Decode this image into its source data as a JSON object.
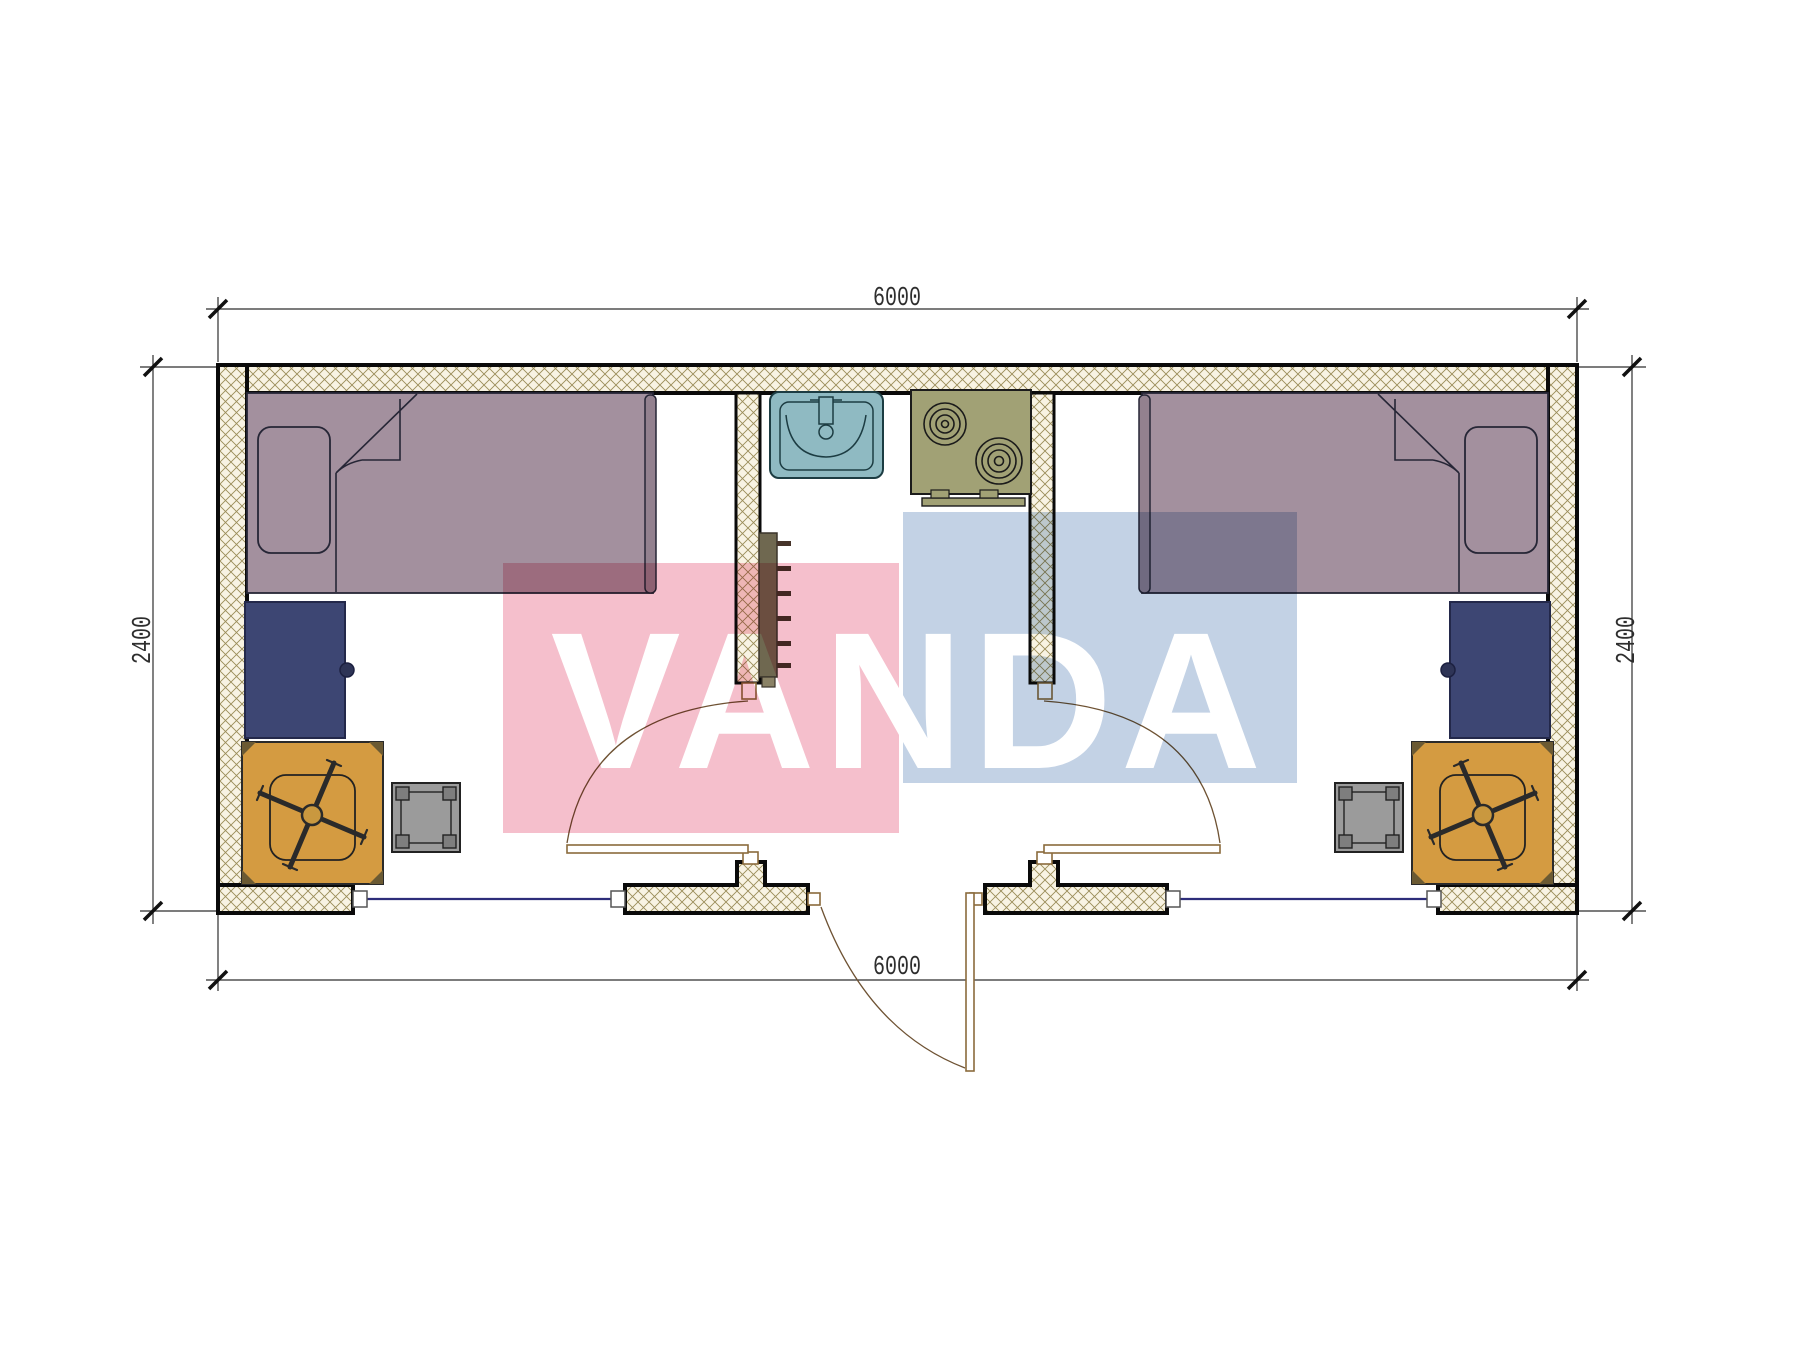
{
  "title": "Container house floor plan 6000 x 2400 - two rooms with central kitchen and sink",
  "watermark": {
    "text": "VANDA",
    "pink_block_color": "#f5bfcc",
    "blue_block_color": "#c3d2e5",
    "letter_color": "#ffffff"
  },
  "dimensions": {
    "top": "6000",
    "bottom": "6000",
    "left": "2400",
    "right": "2400"
  },
  "colors": {
    "wall_hatch_bg": "#f8f3e3",
    "wall_hatch_line": "#9a8c58",
    "wall_outline": "#0a0a0a",
    "bed": "#a3909e",
    "bed_footboard": "#93818f",
    "pillow": "#a3909e",
    "desk": "#3d4673",
    "desk_knob": "#2e3456",
    "chair_mat": "#d49b41",
    "stool": "#9b9b9b",
    "stool_post": "#7e7e7e",
    "sink": "#8fbac2",
    "stove": "#a1a175",
    "radiator": "#6f6850",
    "radiator_rung": "#46342a",
    "door_line": "#8a6b3c",
    "window_line": "#2d2d7a",
    "dimension_line": "#2e2e2e"
  },
  "elements": {
    "left_room": [
      "bed with pillow and folded blanket",
      "desk with knob",
      "office chair on square mat",
      "square stool"
    ],
    "center_core": [
      "wash basin with faucet",
      "two-burner stove",
      "wall radiator ladder"
    ],
    "right_room": [
      "bed with pillow and folded blanket (mirrored)",
      "desk with knob",
      "office chair on square mat",
      "square stool"
    ],
    "doors": [
      "left room swing door",
      "right room swing door",
      "exterior entrance door swinging out"
    ],
    "windows": [
      "bottom-left window",
      "bottom-right window"
    ]
  }
}
